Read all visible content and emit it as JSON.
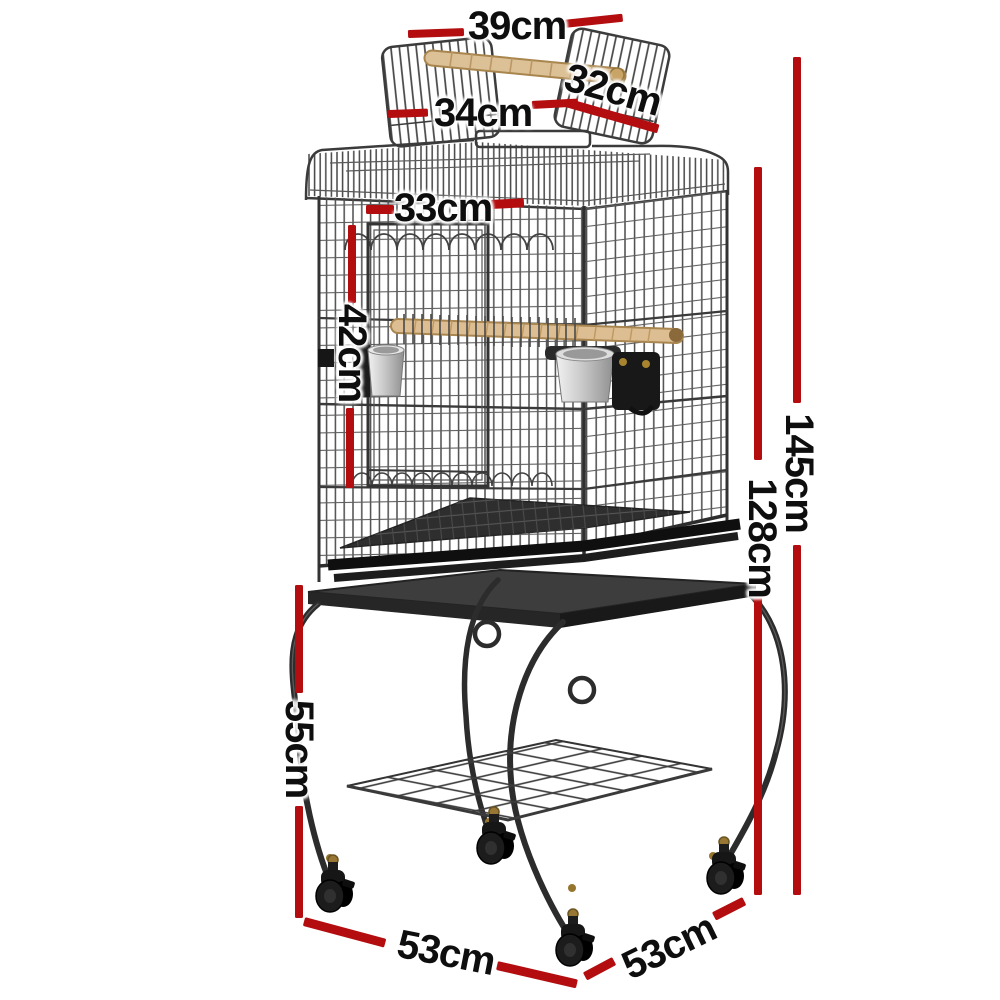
{
  "illustration": {
    "description": "Open-top bird cage with wooden perch handle, feeder cups and perch, on a wheeled stand with mesh shelf and four casters"
  },
  "colors": {
    "dimension_line": "#b30d10",
    "label_text": "#0e0e0e",
    "metal": "#3f3f3f",
    "wood": "#d9bc8e"
  },
  "dims": {
    "top_handle_width": "39cm",
    "roof_door_left": "34cm",
    "roof_door_right": "32cm",
    "front_door_width": "33cm",
    "front_door_height": "42cm",
    "total_height": "145cm",
    "cage_height": "128cm",
    "stand_height": "55cm",
    "base_depth_left": "53cm",
    "base_depth_right": "53cm"
  }
}
